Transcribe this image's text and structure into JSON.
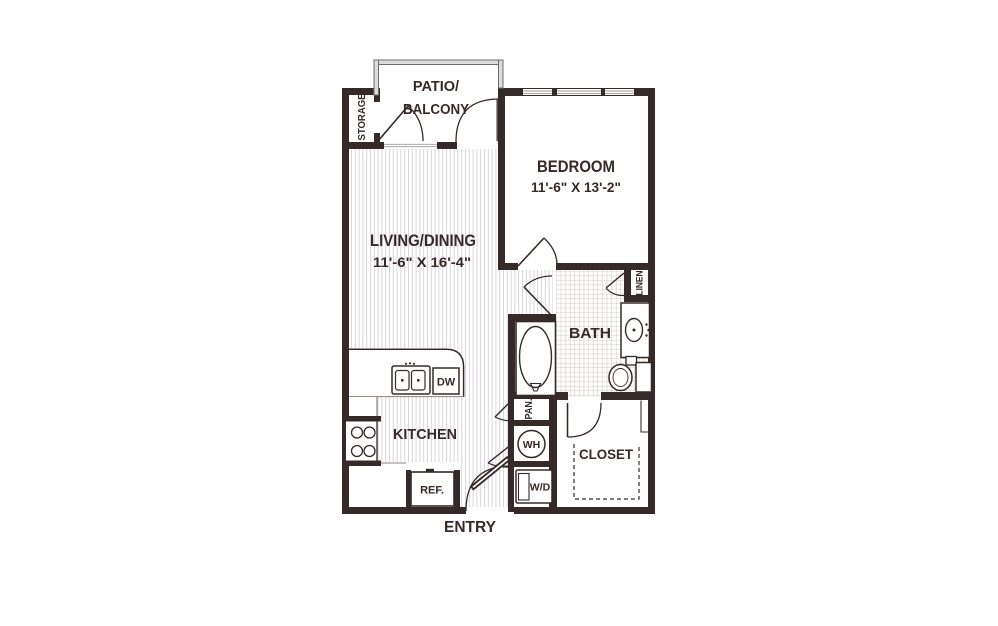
{
  "floorplan": {
    "rooms": {
      "patio": {
        "line1": "PATIO/",
        "line2": "BALCONY"
      },
      "storage": {
        "label": "STORAGE"
      },
      "bedroom": {
        "label": "BEDROOM",
        "dims": "11'-6\" X 13'-2\""
      },
      "living": {
        "label": "LIVING/DINING",
        "dims": "11'-6\" X 16'-4\""
      },
      "kitchen": {
        "label": "KITCHEN"
      },
      "bath": {
        "label": "BATH"
      },
      "closet": {
        "label": "CLOSET"
      },
      "entry": {
        "label": "ENTRY"
      },
      "linen": {
        "label": "LINEN"
      },
      "pantry": {
        "label": "PAN."
      }
    },
    "fixtures": {
      "dishwasher": "DW",
      "refrigerator": "REF.",
      "water_heater": "WH",
      "washer_dryer": "W/D"
    },
    "colors": {
      "wall": "#362a28",
      "patio_wall_fill": "#dcdcdc",
      "patio_wall_edge": "#6e6e6e",
      "floor_hatch": "#d8d6da",
      "bath_tile": "#c4bcb4",
      "window_line": "#9a9a9a",
      "background": "#ffffff"
    }
  }
}
